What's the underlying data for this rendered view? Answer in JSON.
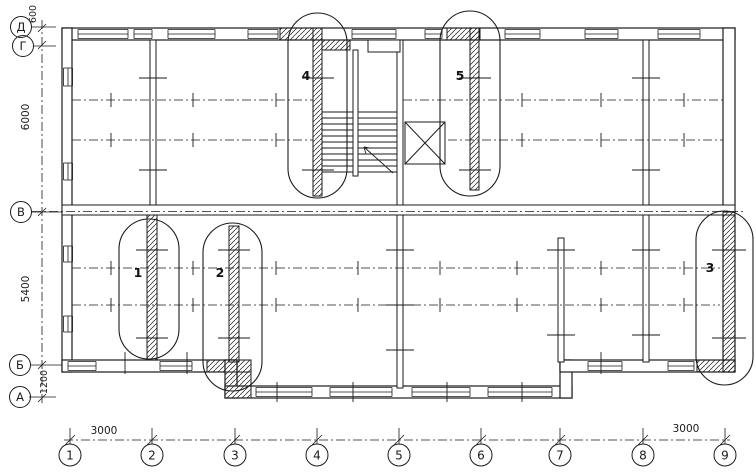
{
  "drawing": {
    "kind": "architectural floor plan",
    "ink_color": "#1b1b1b",
    "paper_color": "#ffffff"
  },
  "axes": {
    "bottom": [
      {
        "label": "1"
      },
      {
        "label": "2"
      },
      {
        "label": "3"
      },
      {
        "label": "4"
      },
      {
        "label": "5"
      },
      {
        "label": "6"
      },
      {
        "label": "7"
      },
      {
        "label": "8"
      },
      {
        "label": "9"
      }
    ],
    "left": [
      {
        "label": "Д"
      },
      {
        "label": "Г"
      },
      {
        "label": "В"
      },
      {
        "label": "Б"
      },
      {
        "label": "А"
      }
    ]
  },
  "dimensions": {
    "top_left_vertical": "600",
    "left_upper": "6000",
    "left_lower": "5400",
    "left_bottom": "1200",
    "bottom_left_bay": "3000",
    "bottom_right_bay": "3000"
  },
  "callouts": [
    {
      "number": "1"
    },
    {
      "number": "2"
    },
    {
      "number": "3"
    },
    {
      "number": "4"
    },
    {
      "number": "5"
    }
  ]
}
